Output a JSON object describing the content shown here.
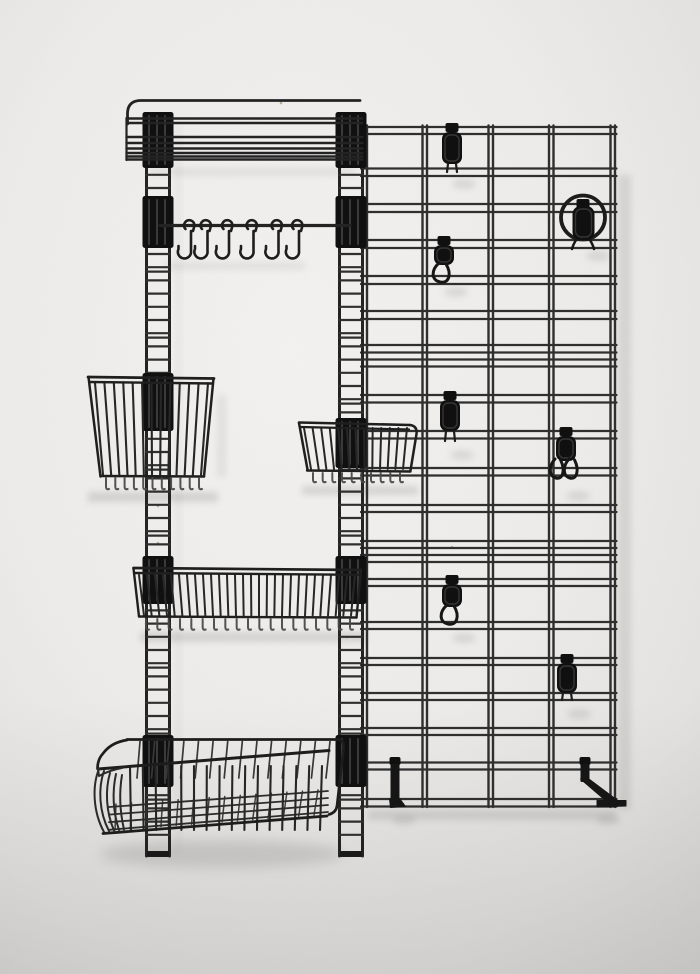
{
  "meta": {
    "description": "Photograph of a black metal wire wall-mounted organizer system on a plain light gray plaster wall",
    "style": "product photo, no visible text"
  },
  "palette": {
    "wall_light": "#f3f2f0",
    "wall": "#ecebe9",
    "wall_dim": "#e2e1df",
    "wall_dark": "#d7d6d4",
    "metal": "#232323",
    "metal_soft": "#2f2f2f",
    "metal_faint": "#3a3a3a",
    "plastic": "#101010",
    "ridge_highlight": "#3f3f3f",
    "comb_highlight": "#4a4a4a",
    "shadow": "#8c8a86",
    "speck": "#b3a28d"
  },
  "left_unit": {
    "label": "ladder-rail wall unit with shelf, hanging rail and wire baskets",
    "rail_count": 2,
    "top_shelf": {
      "label": "wire wall shelf with raised back rail",
      "wire_count": 6
    },
    "hook_rail": {
      "label": "hanging utensil rail",
      "s_hook_count": 6
    },
    "baskets": [
      {
        "id": "magazine-basket",
        "label": "flared wire basket",
        "bar_count": 13
      },
      {
        "id": "small-basket",
        "label": "small wire basket",
        "bar_count": 13
      },
      {
        "id": "shelf-basket",
        "label": "long shallow wire shelf basket",
        "bar_count": 28
      },
      {
        "id": "deep-basket",
        "label": "deep wire storage basket",
        "bar_count": 16
      }
    ]
  },
  "grid_panel": {
    "label": "wire grid wall panel with clip-on accessories",
    "column_count": 4,
    "accessories": [
      {
        "id": "clip-hook-top",
        "variant": "flat-clip",
        "label": "clip hook"
      },
      {
        "id": "loop-hook-upper",
        "variant": "loop-hook",
        "label": "loop hook"
      },
      {
        "id": "ring-holder",
        "variant": "ring",
        "label": "ring holder hook"
      },
      {
        "id": "clip-hook-middle",
        "variant": "flat-clip",
        "label": "clip hook"
      },
      {
        "id": "double-loop-hook",
        "variant": "double-loop",
        "label": "double loop hook"
      },
      {
        "id": "loop-hook-lower",
        "variant": "loop-hook",
        "label": "loop hook"
      },
      {
        "id": "clip-hook-lower",
        "variant": "flat-clip",
        "label": "clip hook"
      },
      {
        "id": "bracket-left",
        "variant": "bracket",
        "label": "shelf bracket"
      },
      {
        "id": "bracket-right",
        "variant": "bracket-arm",
        "label": "shelf bracket with arm"
      }
    ]
  }
}
